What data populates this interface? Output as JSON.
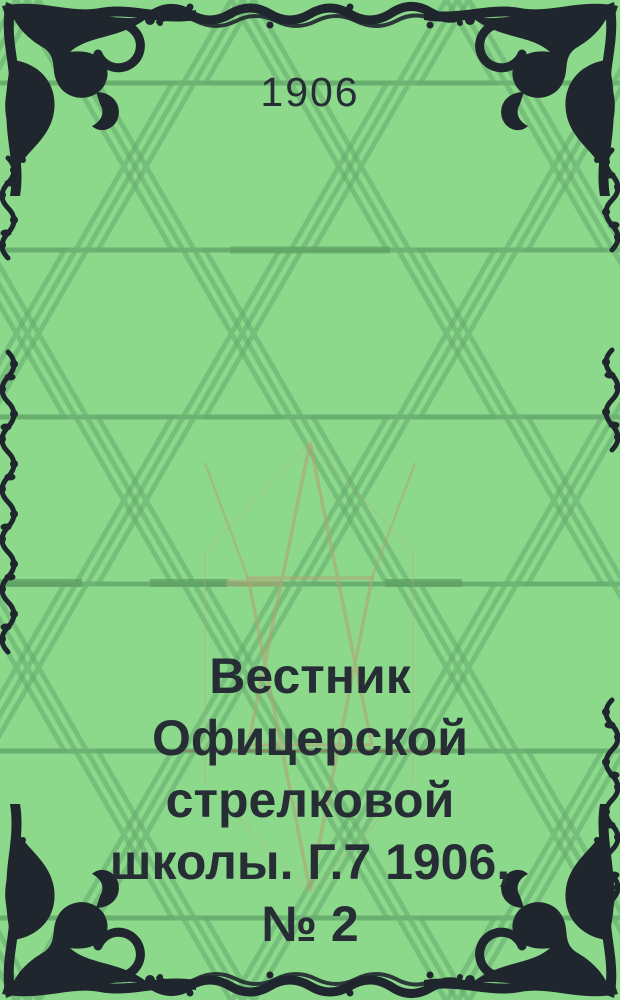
{
  "cover": {
    "year": "1906",
    "title_lines": [
      "Вестник",
      "Офицерской",
      "стрелковой",
      "школы. Г.7 1906,",
      "№ 2"
    ],
    "colors": {
      "background_green": "#8cd98c",
      "pattern_line_green": "#64a96b",
      "pattern_thick_green": "#5d9f63",
      "pattern_tan": "#b0a474",
      "pattern_red_line": "#a05a46",
      "ornament_black": "#1f262e",
      "text_dark": "#272d35"
    }
  }
}
